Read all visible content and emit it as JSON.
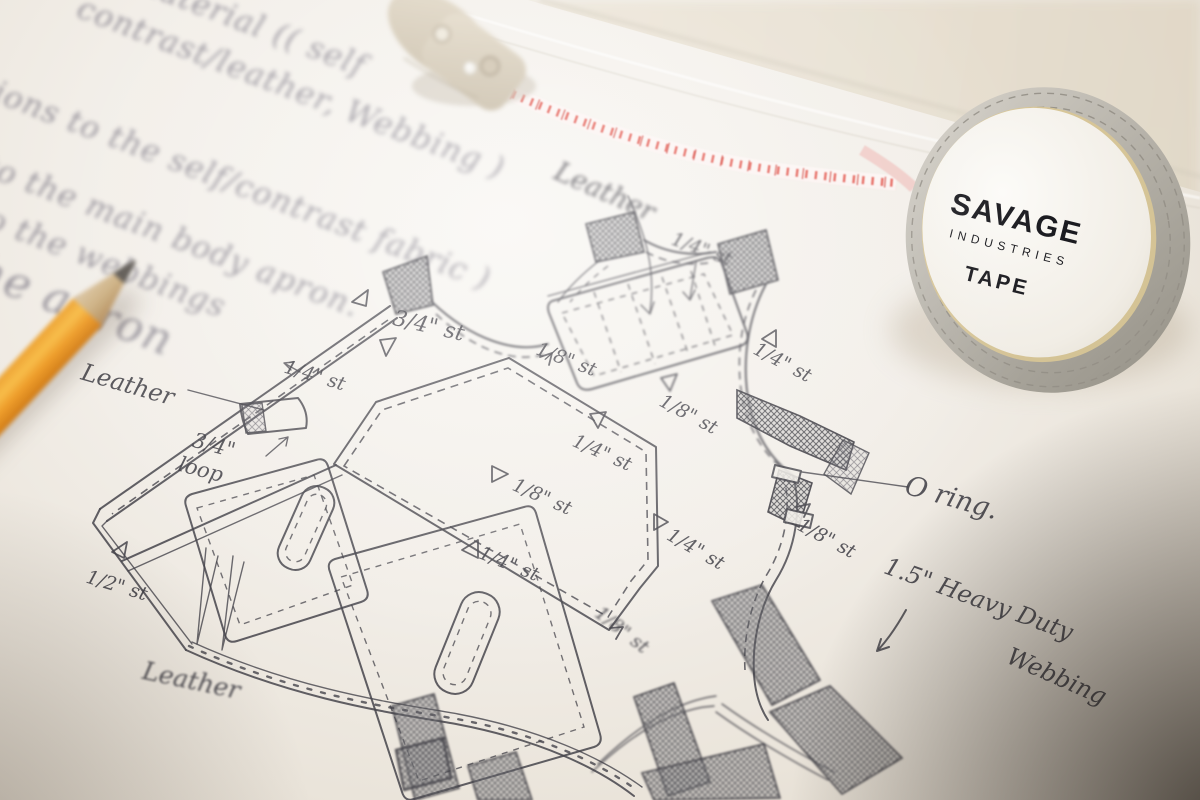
{
  "notes": {
    "line1": "material (( self",
    "line2": "contrast/leather, Webbing )",
    "line3": "positions to the self/contrast fabric )",
    "line4": "to the main body apron.",
    "line5": "to the webbings",
    "line6": "the apron"
  },
  "sketch_labels": {
    "leather_top": "Leather",
    "st_quarter_top": "1/4\" st",
    "st_three_quarter": "3/4\" st",
    "st_quarter_left": "1/4\" st",
    "st_eighth_chest": "1/8\" st",
    "st_eighth_right": "1/8\" st",
    "st_quarter_armhole": "1/4\" st",
    "st_quarter_pocket": "1/4\" st",
    "st_eighth_pocket_mid": "1/8\" st",
    "st_quarter_pocket_right": "1/4\" st",
    "st_eighth_side": "1/8\" st",
    "st_quarter_seam": "1/4\" st",
    "st_half": "1/2\" st",
    "st_eighth_bottom": "1/8\" st",
    "leather_left": "Leather",
    "loop_size": "3/4\"",
    "loop_word": "loop",
    "leather_bottom": "Leather",
    "o_ring": "O ring.",
    "webbing_line1": "1.5\" Heavy Duty",
    "webbing_line2": "Webbing"
  },
  "tape_reel": {
    "brand": "SAVAGE",
    "sub_brand": "INDUSTRIES",
    "product": "TAPE"
  },
  "colors": {
    "pencil_orange": "#f0a437",
    "tape_red": "#e14a41",
    "paper": "#f2eee8",
    "graphite": "#45444b"
  }
}
